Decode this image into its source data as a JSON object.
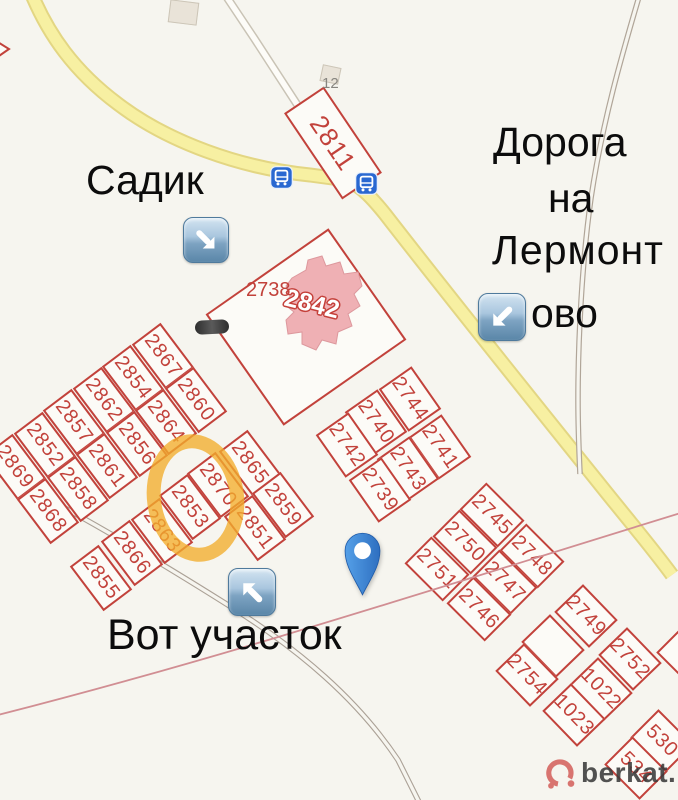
{
  "canvas": {
    "width": 678,
    "height": 800
  },
  "colors": {
    "background": "#f6f5ef",
    "plot_border": "#c2423b",
    "plot_fill": "#fcfbf7",
    "road_yellow": "#f7f0a2",
    "road_yellow_casing": "#e3d683",
    "dirt_road": "#b0a598",
    "boundary_line": "#d18e93",
    "building_pink": "#efb0b4",
    "highlight_orange": "#f2ad2c",
    "pin_blue": "#3b82d0",
    "bus_icon_blue": "#2968d1",
    "watermark_red": "#d4635e"
  },
  "annotations": {
    "kindergarten": "Садик",
    "road_to_lermontovo_full": "Дорога на Лермонтово",
    "road_to_lermontovo_lines": [
      "Дорога",
      "на",
      "Лермонт",
      "ово"
    ],
    "here_is_the_plot": "Вот участок"
  },
  "labels": {
    "house_number": "12",
    "parcel_2738": "2738",
    "building_2842": "2842"
  },
  "markers": {
    "arrow_down_right": "blue-arrow-down-right-icon",
    "arrow_down_left": "blue-arrow-down-left-icon",
    "arrow_up_left": "blue-arrow-up-left-icon",
    "bus_stop": "bus-stop-icon",
    "location_pin": "map-pin-icon",
    "highlight": "orange-highlight-circle"
  },
  "watermark": {
    "text": "berkat."
  },
  "plots": [
    {
      "label": "2811",
      "x": 333,
      "y": 143,
      "w": 48,
      "h": 104,
      "r": -34,
      "fs": 26
    },
    {
      "label": "",
      "x": 306,
      "y": 327,
      "w": 150,
      "h": 136,
      "r": -35
    },
    {
      "label": "2867",
      "x": 163,
      "y": 356,
      "w": 36,
      "h": 56,
      "r": -37
    },
    {
      "label": "2854",
      "x": 133,
      "y": 378,
      "w": 36,
      "h": 56,
      "r": -37
    },
    {
      "label": "2862",
      "x": 104,
      "y": 400,
      "w": 36,
      "h": 56,
      "r": -37
    },
    {
      "label": "2857",
      "x": 74,
      "y": 422,
      "w": 36,
      "h": 56,
      "r": -37
    },
    {
      "label": "2852",
      "x": 45,
      "y": 445,
      "w": 36,
      "h": 56,
      "r": -37
    },
    {
      "label": "2869",
      "x": 15,
      "y": 467,
      "w": 36,
      "h": 56,
      "r": -37
    },
    {
      "label": "2860",
      "x": 196,
      "y": 400,
      "w": 36,
      "h": 56,
      "r": -37
    },
    {
      "label": "2864",
      "x": 166,
      "y": 422,
      "w": 36,
      "h": 56,
      "r": -37
    },
    {
      "label": "2856",
      "x": 137,
      "y": 444,
      "w": 36,
      "h": 56,
      "r": -37
    },
    {
      "label": "2861",
      "x": 107,
      "y": 466,
      "w": 36,
      "h": 56,
      "r": -37
    },
    {
      "label": "2858",
      "x": 78,
      "y": 489,
      "w": 36,
      "h": 56,
      "r": -37
    },
    {
      "label": "2868",
      "x": 48,
      "y": 511,
      "w": 36,
      "h": 56,
      "r": -37
    },
    {
      "label": "2865",
      "x": 250,
      "y": 463,
      "w": 36,
      "h": 56,
      "r": -37
    },
    {
      "label": "2870",
      "x": 218,
      "y": 485,
      "w": 36,
      "h": 56,
      "r": -37
    },
    {
      "label": "2853",
      "x": 190,
      "y": 507,
      "w": 36,
      "h": 56,
      "r": -37
    },
    {
      "label": "2863",
      "x": 162,
      "y": 531,
      "w": 36,
      "h": 56,
      "r": -37
    },
    {
      "label": "2866",
      "x": 132,
      "y": 553,
      "w": 36,
      "h": 56,
      "r": -37
    },
    {
      "label": "2855",
      "x": 101,
      "y": 578,
      "w": 36,
      "h": 56,
      "r": -37
    },
    {
      "label": "2859",
      "x": 283,
      "y": 505,
      "w": 36,
      "h": 56,
      "r": -37
    },
    {
      "label": "2851",
      "x": 255,
      "y": 528,
      "w": 36,
      "h": 56,
      "r": -37
    },
    {
      "label": "2744",
      "x": 410,
      "y": 399,
      "w": 40,
      "h": 52,
      "r": -35
    },
    {
      "label": "2740",
      "x": 376,
      "y": 422,
      "w": 40,
      "h": 52,
      "r": -35
    },
    {
      "label": "2742",
      "x": 347,
      "y": 445,
      "w": 40,
      "h": 52,
      "r": -35
    },
    {
      "label": "2741",
      "x": 440,
      "y": 447,
      "w": 40,
      "h": 52,
      "r": -35
    },
    {
      "label": "2743",
      "x": 408,
      "y": 469,
      "w": 40,
      "h": 52,
      "r": -35
    },
    {
      "label": "2739",
      "x": 380,
      "y": 490,
      "w": 40,
      "h": 52,
      "r": -35
    },
    {
      "label": "2745",
      "x": 492,
      "y": 515,
      "w": 38,
      "h": 54,
      "r": -45
    },
    {
      "label": "2750",
      "x": 465,
      "y": 542,
      "w": 38,
      "h": 54,
      "r": -45
    },
    {
      "label": "2751",
      "x": 437,
      "y": 569,
      "w": 38,
      "h": 54,
      "r": -45
    },
    {
      "label": "2748",
      "x": 532,
      "y": 556,
      "w": 38,
      "h": 54,
      "r": -45
    },
    {
      "label": "2747",
      "x": 505,
      "y": 582,
      "w": 38,
      "h": 54,
      "r": -45
    },
    {
      "label": "2746",
      "x": 479,
      "y": 609,
      "w": 38,
      "h": 54,
      "r": -45
    },
    {
      "label": "2749",
      "x": 586,
      "y": 616,
      "w": 40,
      "h": 50,
      "r": -44
    },
    {
      "label": "",
      "x": 553,
      "y": 646,
      "w": 40,
      "h": 50,
      "r": -44
    },
    {
      "label": "2754",
      "x": 527,
      "y": 675,
      "w": 40,
      "h": 50,
      "r": -44
    },
    {
      "label": "2752",
      "x": 630,
      "y": 659,
      "w": 40,
      "h": 50,
      "r": -44
    },
    {
      "label": "1022",
      "x": 601,
      "y": 689,
      "w": 40,
      "h": 50,
      "r": -44
    },
    {
      "label": "1023",
      "x": 574,
      "y": 715,
      "w": 40,
      "h": 50,
      "r": -44
    },
    {
      "label": "530",
      "x": 662,
      "y": 741,
      "w": 40,
      "h": 50,
      "r": -45
    },
    {
      "label": "534",
      "x": 636,
      "y": 768,
      "w": 40,
      "h": 50,
      "r": -45
    },
    {
      "label": "",
      "x": 688,
      "y": 656,
      "w": 40,
      "h": 50,
      "r": -45
    }
  ]
}
